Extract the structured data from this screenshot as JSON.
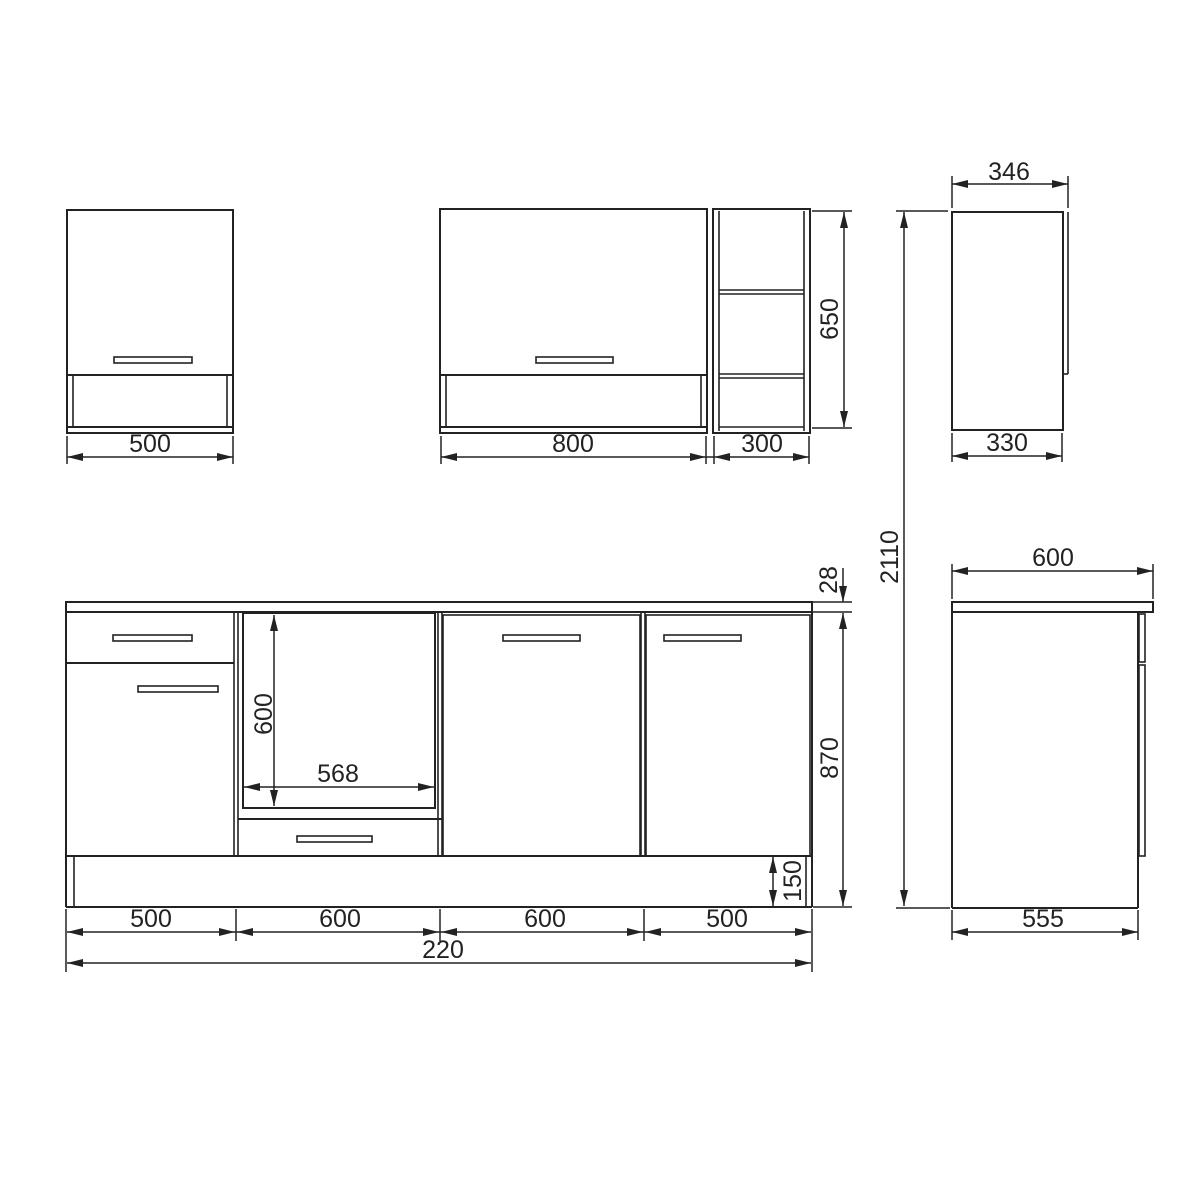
{
  "drawing": {
    "line_color": "#222222",
    "wall_cabinet_small": {
      "width": "500"
    },
    "wall_cabinet_large": {
      "width": "800",
      "shelf_width": "300",
      "height": "650"
    },
    "wall_cabinet_side": {
      "depth_with_door": "346",
      "depth": "330"
    },
    "overall": {
      "total_height": "2110",
      "total_width": "220"
    },
    "base_run": {
      "oven_opening_height": "600",
      "oven_opening_width": "568",
      "worktop_thickness": "28",
      "base_height": "870",
      "plinth_height": "150",
      "segment_widths": [
        "500",
        "600",
        "600",
        "500"
      ]
    },
    "base_side": {
      "depth_with_worktop": "600",
      "depth": "555"
    }
  }
}
